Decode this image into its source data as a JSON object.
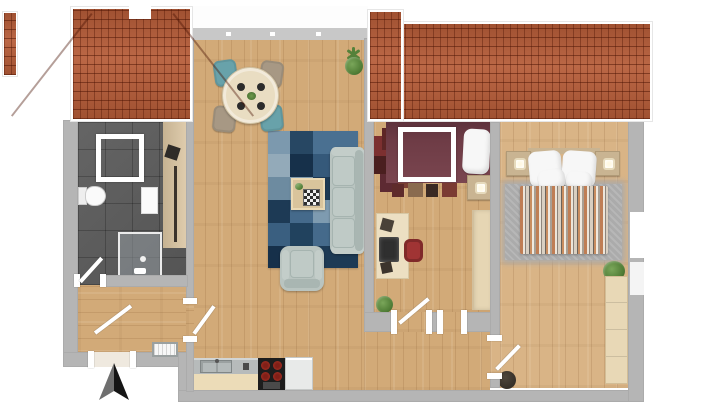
{
  "scene": {
    "description": "3d-top-down-apartment-floor-plan-render",
    "rooms": [
      {
        "name": "bathroom"
      },
      {
        "name": "entry-hall"
      },
      {
        "name": "living-dining-room"
      },
      {
        "name": "kitchen-strip"
      },
      {
        "name": "small-bedroom-office"
      },
      {
        "name": "hallway"
      },
      {
        "name": "main-bedroom"
      }
    ],
    "furniture": {
      "bathroom": [
        "shower-enclosure",
        "toilet",
        "wall-shelf",
        "glass-shower",
        "bath-cabinet",
        "towel-radiator"
      ],
      "living_dining": [
        "round-dining-table",
        "four-dining-chairs",
        "potted-plant",
        "blue-patchwork-rug",
        "coffee-table-with-chessboard",
        "three-seat-sofa",
        "armchair"
      ],
      "kitchen": [
        "countertop",
        "double-sink",
        "stove-four-burners",
        "appliance"
      ],
      "small_bedroom": [
        "dark-red-bed",
        "white-bed-frame",
        "pillow",
        "red-patchwork-rug",
        "nightstand-with-lamp",
        "wardrobe",
        "desk",
        "monitor",
        "red-office-chair",
        "potted-plant"
      ],
      "main_bedroom": [
        "double-bed",
        "four-pillows",
        "striped-duvet",
        "two-nightstands-with-lamps",
        "gray-fluffy-rug",
        "dresser",
        "potted-plant",
        "dark-pouf"
      ],
      "entry": [
        "radiator",
        "entrance-door"
      ]
    },
    "architecture": [
      "two-red-tile-roofs",
      "neighbor-roof-strip",
      "roof-dormer-notch",
      "balcony-strip",
      "window-band",
      "interior-doors",
      "right-wall-window"
    ]
  },
  "icons": {
    "compass": "north-arrow-icon"
  },
  "colors": {
    "wall": "#b5b5b5",
    "window_sill": "#c8c8c8",
    "floor_wood": "#d2aa78",
    "floor_wood_light": "#d9b486",
    "bath_tile": "#5b5b5b",
    "bath_cabinet": "#dcc6a2",
    "roof_tile": "#b65c38",
    "rug_blue": "#40627e",
    "gray_rug": "#ababab",
    "sofa": "#b9c4c0",
    "sofa_shade": "#a9b6b2",
    "sofa_light": "#c3cdc9",
    "dining_table": "#e9ddc2",
    "chair_teal": "#68a2aa",
    "chair_taupe": "#a79884",
    "coffee_table": "#d9c49c",
    "maroon_bed": "#6e3c46",
    "nightstand": "#c9b492",
    "wardrobe": "#e6d6b4",
    "desk": "#ecdfc2",
    "office_chair_red": "#a03434",
    "duvet_orange": "#bf7e55",
    "counter_top": "#b7bbbb",
    "counter_front": "#ecdcb8",
    "stove_black": "#1d1d1d",
    "burner_red": "#b23527",
    "appliance": "#e8eae9",
    "dresser": "#e8d8b6",
    "plant_green": "#4f7c35",
    "compass_dark": "#151515",
    "compass_light": "#6f6f6f"
  }
}
